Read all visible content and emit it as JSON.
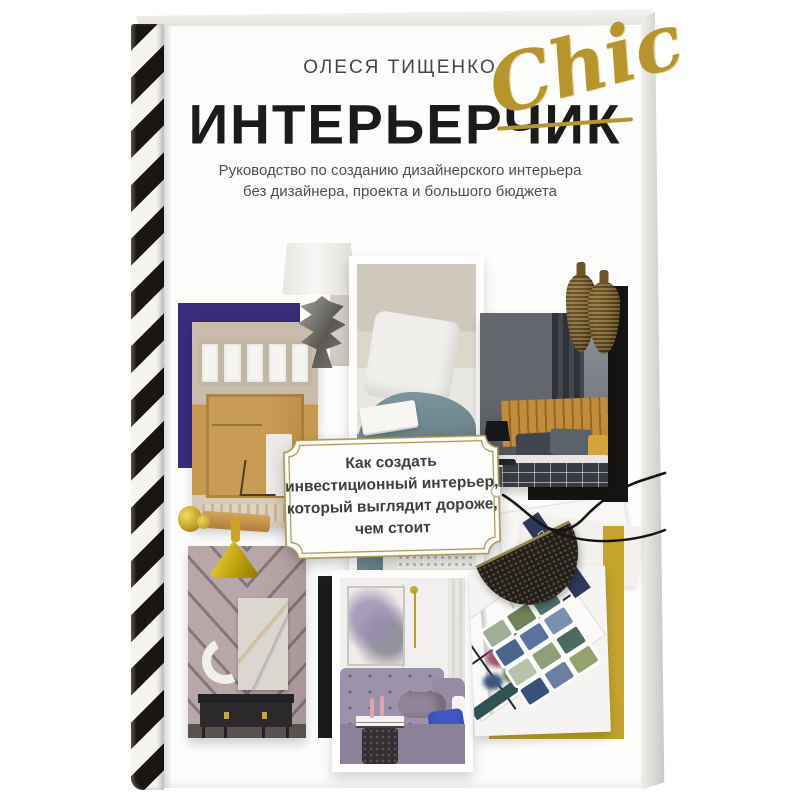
{
  "book": {
    "author": "ОЛЕСЯ ТИЩЕНКО",
    "title": "ИНТЕРЬЕРЧИК",
    "title_script_overlay": "Chic",
    "subtitle": "Руководство по созданию дизайнерского интерьера\nбез дизайнера, проекта и большого бюджета",
    "center_badge_text": "Как создать\nинвестиционный интерьер,\nкоторый выглядит дороже,\nчем стоит",
    "magazine_spine_text": "DESIGN",
    "colors": {
      "title_ink": "#1b1b1b",
      "script_gold": "#b5952c",
      "badge_border_gold": "#a8944d",
      "purple_frame": "#3a2b7d",
      "mustard_frame": "#c5a32c",
      "spine_stripe_black": "#1a1614",
      "headboard_gold": "#bf8d3c",
      "sofa_lavender": "#9d92ab",
      "blanket_teal": "#7e969d"
    },
    "collage_photos": [
      {
        "name": "doorway-kitchen-photo"
      },
      {
        "name": "table-lamp-cutout"
      },
      {
        "name": "window-seat-bedroom-card"
      },
      {
        "name": "dark-bedroom-photo"
      },
      {
        "name": "bronze-vases-cutout"
      },
      {
        "name": "chevron-wall-console-photo"
      },
      {
        "name": "lavender-sofa-card"
      },
      {
        "name": "swatch-moodboard-photo"
      },
      {
        "name": "brass-handle-and-cone-pendant"
      }
    ],
    "swatch_colors": [
      "#9fae96",
      "#6f8259",
      "#53766f",
      "#4a648e",
      "#5b719f",
      "#7b8fae",
      "#b7c2ac",
      "#8da077",
      "#4c6a5e",
      "#37527b",
      "#6b7fa0",
      "#93a26f"
    ]
  }
}
